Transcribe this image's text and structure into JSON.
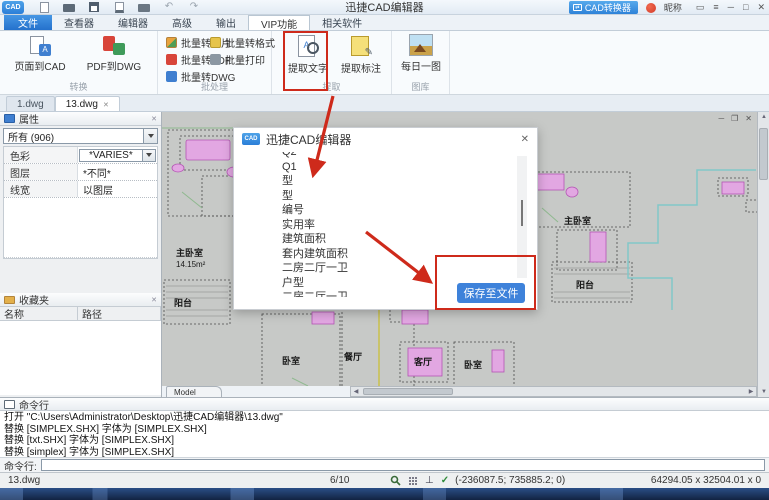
{
  "titlebar": {
    "app_title": "迅捷CAD编辑器",
    "converter_button": "CAD转换器",
    "nickname": "昵称"
  },
  "menubar": {
    "tabs": [
      "文件",
      "查看器",
      "编辑器",
      "高级",
      "输出",
      "VIP功能",
      "相关软件"
    ]
  },
  "ribbon": {
    "convert": {
      "label": "转换",
      "buttons": [
        "页面到CAD",
        "PDF到DWG"
      ]
    },
    "batch": {
      "label": "批处理",
      "buttons": [
        "批量转图片",
        "批量转PDF",
        "批量转DWG",
        "批量转格式",
        "批量打印"
      ]
    },
    "extract": {
      "label": "提取",
      "buttons": [
        "提取文字",
        "提取标注"
      ]
    },
    "gallery": {
      "label": "图库",
      "buttons": [
        "每日一图"
      ]
    }
  },
  "doc_tabs": [
    "1.dwg",
    "13.dwg"
  ],
  "properties_panel": {
    "title": "属性",
    "filter_value": "所有 (906)",
    "rows": [
      {
        "label": "色彩",
        "value": "*VARIES*"
      },
      {
        "label": "图层",
        "value": "*不同*"
      },
      {
        "label": "线宽",
        "value": "以图层"
      }
    ]
  },
  "favorites_panel": {
    "title": "收藏夹",
    "columns": [
      "名称",
      "路径"
    ]
  },
  "drawing": {
    "model_tab": "Model",
    "rooms": [
      {
        "name": "主卧室",
        "area": "14.15m²"
      },
      {
        "name": "阳台"
      },
      {
        "name": "卧室"
      },
      {
        "name": "餐厅"
      },
      {
        "name": "客厅"
      },
      {
        "name": "卧室"
      },
      {
        "name": "主卧室"
      },
      {
        "name": "阳台"
      }
    ]
  },
  "dialog": {
    "title": "迅捷CAD编辑器",
    "lines": [
      "Q2",
      "Q1",
      "型",
      "型",
      "编号",
      "实用率",
      "建筑面积",
      "套内建筑面积",
      "二房二厅一卫",
      "户型",
      "二房二厅一卫"
    ],
    "save_button": "保存至文件"
  },
  "command_panel": {
    "title": "命令行",
    "log": [
      "打开 \"C:\\Users\\Administrator\\Desktop\\迅捷CAD编辑器\\13.dwg\"",
      "替换 [SIMPLEX.SHX] 字体为 [SIMPLEX.SHX]",
      "替换 [txt.SHX] 字体为 [SIMPLEX.SHX]",
      "替换 [simplex] 字体为 [SIMPLEX.SHX]"
    ],
    "prompt": "命令行:"
  },
  "status_bar": {
    "file": "13.dwg",
    "progress": "6/10",
    "coords": "(-236087.5; 735885.2; 0)",
    "extent": "64294.05 x 32504.01 x 0"
  },
  "colors": {
    "accent_blue": "#2e7cd6",
    "annotation_red": "#ce2a1b",
    "button_blue": "#3e82da",
    "drawing_magenta": "#cc66cc",
    "drawing_teal": "#82c7c9"
  }
}
